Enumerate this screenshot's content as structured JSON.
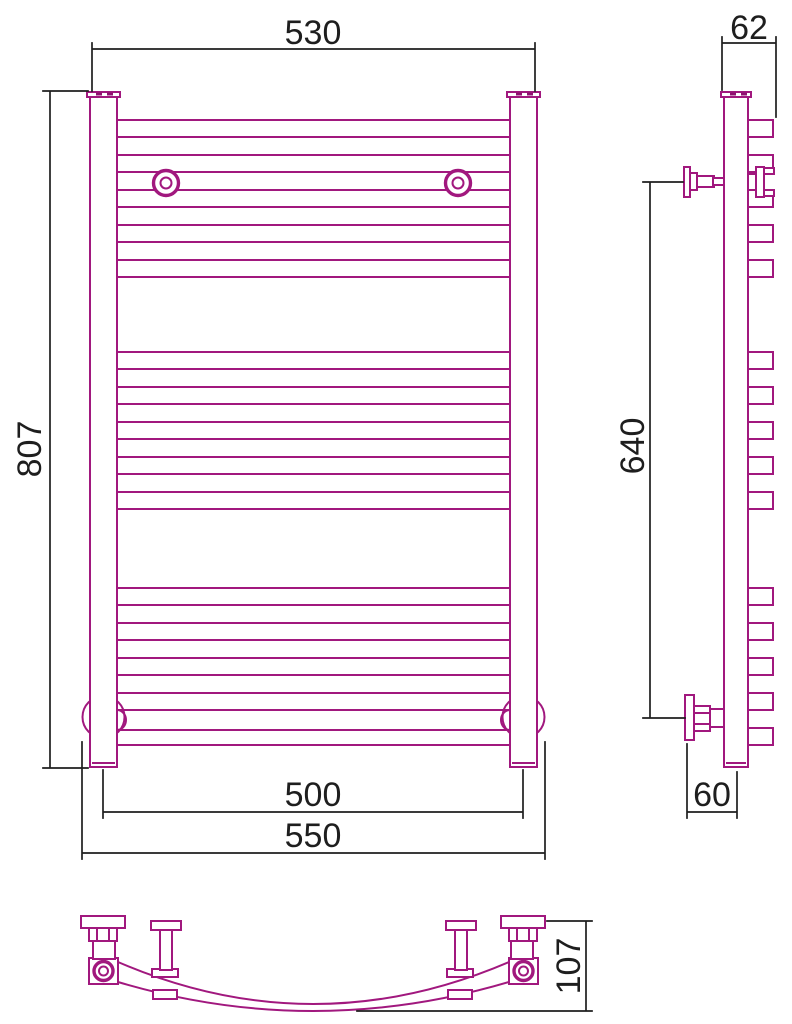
{
  "drawing": {
    "type": "technical-drawing",
    "subject": "ladder heated towel rail, three orthographic views",
    "line_color": "#A1187E",
    "dimension_color": "#1E1E1E",
    "background": "#FFFFFF",
    "dimensions": {
      "front_overall_width": {
        "value": "530"
      },
      "side_depth_top": {
        "value": "62"
      },
      "front_overall_height": {
        "value": "807"
      },
      "side_bracket_span": {
        "value": "640"
      },
      "front_pipe_centers": {
        "value": "500"
      },
      "front_bracket_span": {
        "value": "550"
      },
      "side_wall_offset": {
        "value": "60"
      },
      "bottom_view_depth": {
        "value": "107"
      }
    }
  }
}
